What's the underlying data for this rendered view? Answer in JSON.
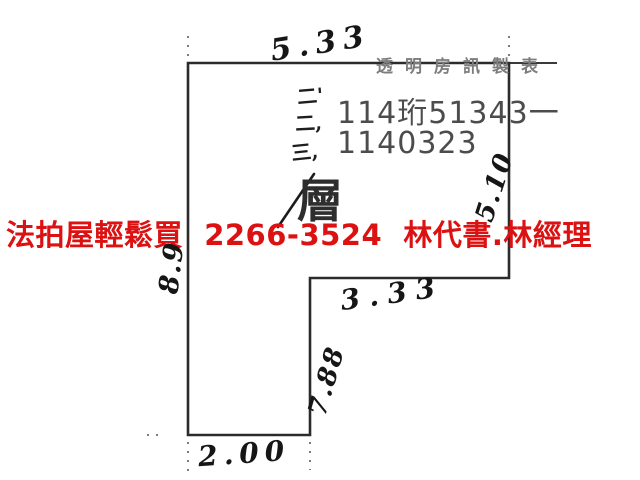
{
  "meta": {
    "description": "Scanned hand-drawn floor plan sketch of a foreclosure property with dimension annotations",
    "background_color": "#ffffff",
    "outline_color": "#2b2b2b",
    "ink_color": "#161616",
    "print_color": "#4c4c4c",
    "watermark_color": "#7d7d7d",
    "banner_color": "#dc1111"
  },
  "watermark": {
    "text": "透明房訊製表"
  },
  "case_numbers": {
    "line1": "114珩51343一",
    "line2": "1140323"
  },
  "floor_annotation": {
    "marks": [
      "二'",
      "二,",
      "三,"
    ],
    "floor_char": "層"
  },
  "banner": {
    "text": "法拍屋輕鬆買  2266-3524  林代書.林經理"
  },
  "dimensions": {
    "top": "5.33",
    "right_upper": "5.10",
    "left": "8.9",
    "step": "3.33",
    "right_lower": "7.88",
    "bottom": "2.00"
  }
}
